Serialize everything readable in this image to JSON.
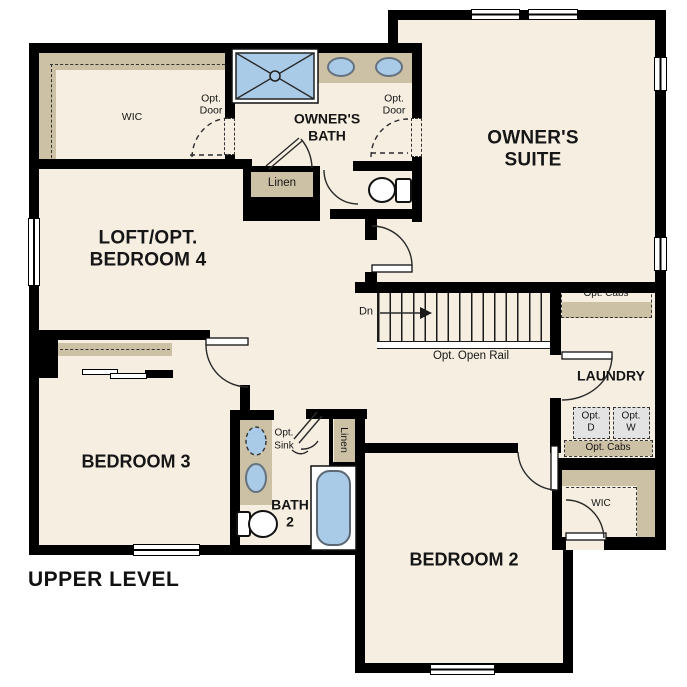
{
  "title": "UPPER LEVEL",
  "rooms": {
    "wic_upper": "WIC",
    "owners_bath": [
      "OWNER'S",
      "BATH"
    ],
    "owners_suite": [
      "OWNER'S",
      "SUITE"
    ],
    "loft": [
      "LOFT/OPT.",
      "BEDROOM 4"
    ],
    "bedroom3": "BEDROOM 3",
    "bedroom2": "BEDROOM 2",
    "laundry": "LAUNDRY",
    "bath2": [
      "BATH",
      "2"
    ],
    "wic_lower": "WIC"
  },
  "annotations": {
    "opt_door_left": [
      "Opt.",
      "Door"
    ],
    "opt_door_right": [
      "Opt.",
      "Door"
    ],
    "linen_bath": "Linen",
    "linen_hall": "Linen",
    "opt_sink": [
      "Opt.",
      "Sink"
    ],
    "opt_cabs_upper": "Opt. Cabs",
    "opt_cabs_lower": "Opt. Cabs",
    "opt_dryer": [
      "Opt.",
      "D"
    ],
    "opt_washer": [
      "Opt.",
      "W"
    ],
    "opt_open_rail": "Opt. Open Rail",
    "stairs_down": "Dn"
  },
  "colors": {
    "floor": "#f5eee1",
    "casework": "#ccc0a5",
    "fixture_blue": "#a9cbe8",
    "appliance_gray": "#e3e3e3",
    "wall": "#000000"
  }
}
